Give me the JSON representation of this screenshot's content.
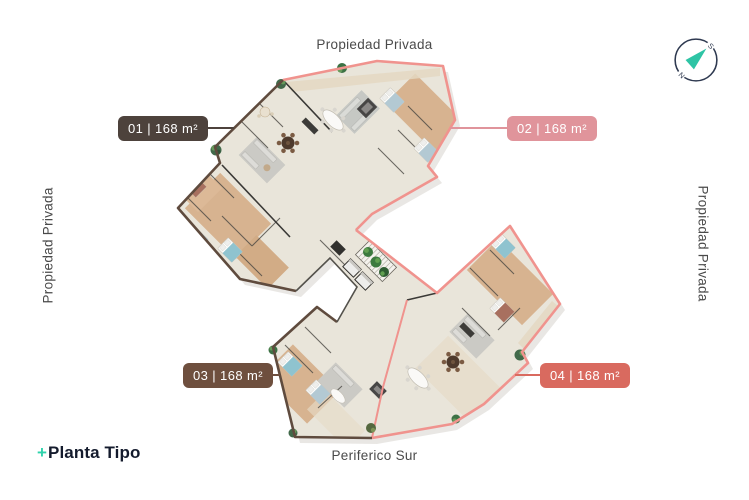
{
  "boundaries": {
    "top": "Propiedad Privada",
    "left": "Propiedad Privada",
    "right": "Propiedad Privada",
    "bottom_road": "Periferico Sur"
  },
  "units": [
    {
      "id": "01",
      "label": "01 | 168 m²",
      "badge_color": "#4d423c"
    },
    {
      "id": "02",
      "label": "02 | 168 m²",
      "badge_color": "#e0949b"
    },
    {
      "id": "03",
      "label": "03 | 168 m²",
      "badge_color": "#6e4f3e"
    },
    {
      "id": "04",
      "label": "04 | 168 m²",
      "badge_color": "#d96a5f"
    }
  ],
  "compass": {
    "south": "S",
    "north": "N",
    "arrow_color": "#2ec4a5",
    "ring_color": "#2e3950"
  },
  "logo": {
    "plus": "+",
    "text": "Planta Tipo"
  },
  "plan_colors": {
    "salmon": "#f0938e",
    "brown": "#5f4b3e",
    "floor": "#e9e5da",
    "wood": "#d7b390"
  }
}
